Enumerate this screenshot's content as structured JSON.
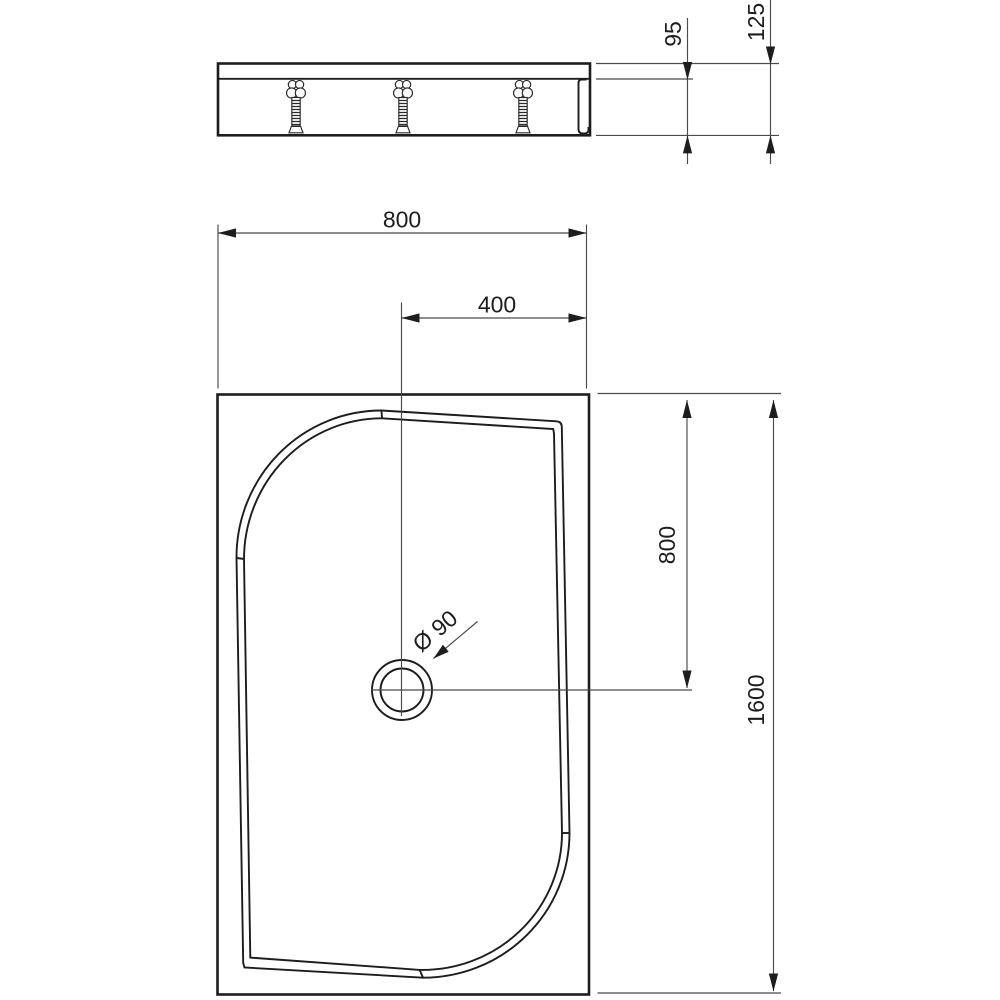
{
  "drawing": {
    "dims": {
      "top_width": "800",
      "drain_offset_x": "400",
      "drain_offset_y": "800",
      "overall_length": "1600",
      "body_depth": "95",
      "overall_height": "125",
      "drain_diameter": "Ø 90"
    },
    "colors": {
      "line": "#1d1d1b",
      "thin_line": "#4a4a4a",
      "background": "#ffffff"
    }
  }
}
